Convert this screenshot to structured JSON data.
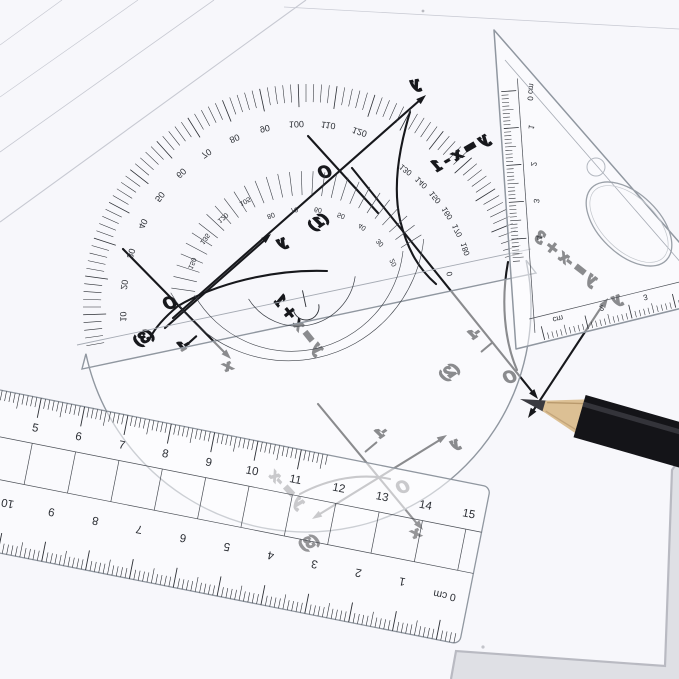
{
  "scene": {
    "description": "Photo of transparent geometry tools (protractor, set-square, ruler) and a pencil on white paper with hand-drawn linear function graphs",
    "background_color": "#dfe0e5",
    "paper_color": "#f7f7fb",
    "ink_color": "#17181c",
    "plastic_edge_color": "#9097a0"
  },
  "sketch_graphs": [
    {
      "id": "g1",
      "number_label": "(1)",
      "equation": "y = x - 1",
      "origin_label": "O",
      "y_label": "y",
      "x_label": "",
      "tick_label": ""
    },
    {
      "id": "g2",
      "number_label": "(2)",
      "equation": "y = -x + 3",
      "origin_label": "O",
      "y_label": "y",
      "x_label": "",
      "tick_label": "-1"
    },
    {
      "id": "g3",
      "number_label": "(3)",
      "equation": "y = x + 1",
      "origin_label": "O",
      "y_label": "y",
      "x_label": "x",
      "tick_label": "-1"
    },
    {
      "id": "g4",
      "number_label": "(3)",
      "equation": "y = -x",
      "origin_label": "O",
      "y_label": "y",
      "x_label": "x",
      "tick_label": "-1"
    }
  ],
  "protractor": {
    "outer_ring_numbers": [
      "10",
      "20",
      "30",
      "40",
      "50",
      "60",
      "70",
      "80",
      "90",
      "100",
      "110",
      "120"
    ],
    "outer_ring_zero": "0",
    "second_ring_numbers": [
      "130",
      "140",
      "150",
      "160",
      "170",
      "180"
    ],
    "inner_left_numbers": [
      "150",
      "135",
      "120",
      "105"
    ],
    "inner_right_numbers": [
      "80",
      "70",
      "60",
      "50",
      "40",
      "30",
      "20"
    ]
  },
  "triangle": {
    "left_scale_zero": "0 cm",
    "left_scale_numbers": [
      "1",
      "2",
      "3",
      "4"
    ],
    "bottom_scale_labels": [
      "cm",
      "2",
      "3"
    ]
  },
  "ruler": {
    "top_scale_numbers": [
      "4",
      "5",
      "6",
      "7",
      "8",
      "9",
      "10",
      "11",
      "12",
      "13",
      "14",
      "15"
    ],
    "bottom_scale_numbers": [
      "10",
      "9",
      "8",
      "7",
      "6",
      "5",
      "4",
      "3",
      "2",
      "1"
    ],
    "bottom_scale_zero": "0 cm"
  },
  "pencil": {
    "body_color": "#141418",
    "wood_color": "#dcc094",
    "lead_color": "#3a3a40"
  }
}
